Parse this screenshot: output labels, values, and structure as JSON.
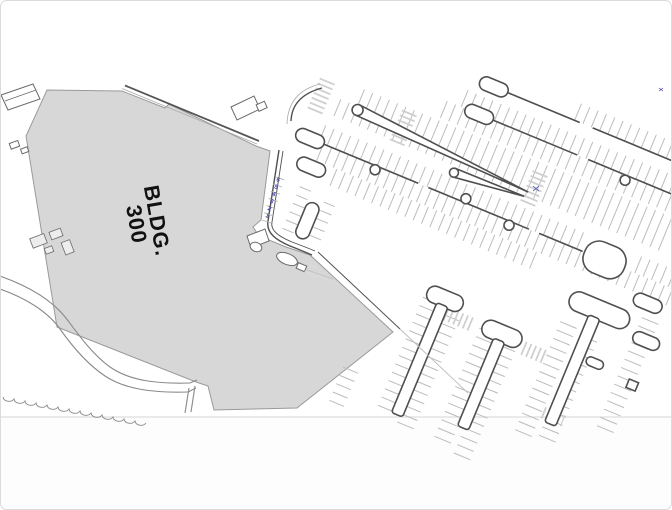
{
  "plan": {
    "background": "#ffffff",
    "frame": "#dcdcdc",
    "building": {
      "label_line1": "BLDG.",
      "label_line2": "300",
      "fill": "#d7d7d7",
      "outline": "#9a9a9a",
      "label_color": "#111111"
    },
    "stall_numbers": {
      "values": [
        "1",
        "2",
        "3",
        "4",
        "5",
        "6"
      ],
      "color": "#4545b5"
    },
    "linework": {
      "curb": "#4f4f4f",
      "stall": "#bcbcbc",
      "crosswalk": "#cfcfcf",
      "walkway": "#8a8a8a",
      "structure": "#6a6a6a",
      "faint": "#e3e3e3"
    }
  }
}
